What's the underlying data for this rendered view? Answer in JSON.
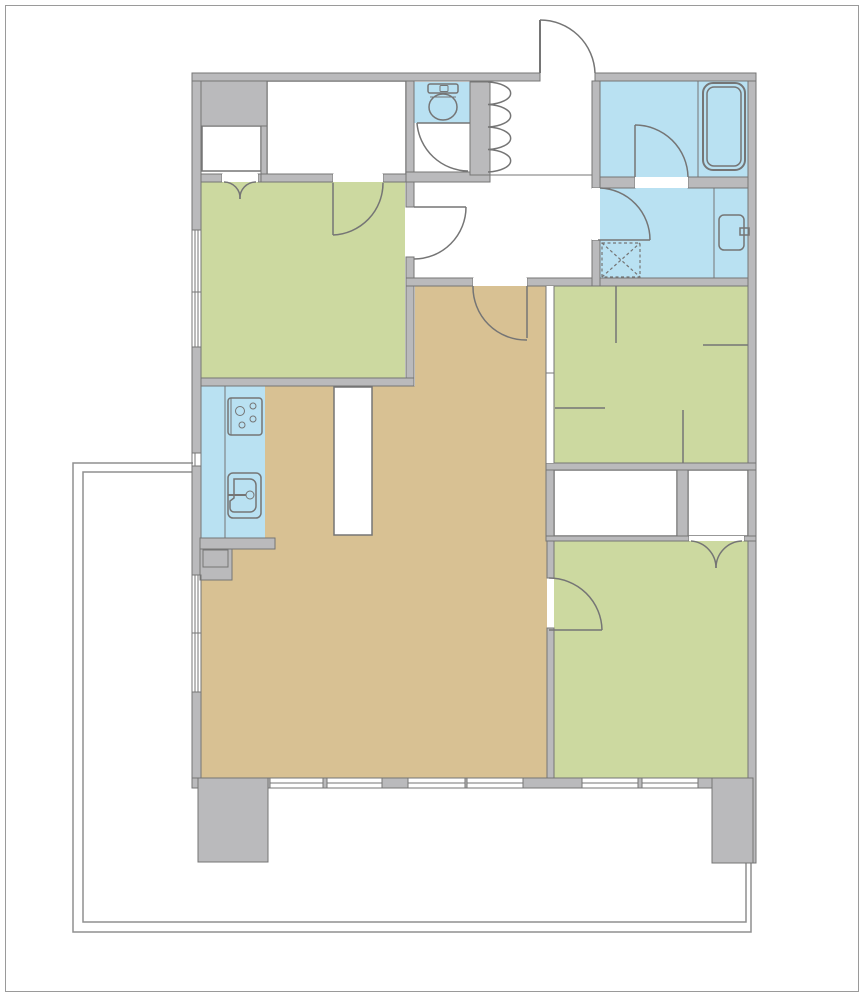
{
  "document": {
    "kind": "apartment-floor-plan",
    "visible_text": []
  },
  "colors": {
    "wall": "#bababc",
    "outline": "#757575",
    "tan": "#d8c193",
    "green": "#ccd9a0",
    "blue": "#b9e1f2",
    "white": "#ffffff",
    "balcony": "#8f8f8f",
    "frame": "#9a9a9a"
  },
  "rooms": [
    {
      "name": "living-dining-kitchen",
      "color_key": "tan"
    },
    {
      "name": "bedroom-west",
      "color_key": "green"
    },
    {
      "name": "bedroom-northeast",
      "color_key": "green"
    },
    {
      "name": "bedroom-southeast",
      "color_key": "green"
    },
    {
      "name": "kitchen-counter-strip",
      "color_key": "blue"
    },
    {
      "name": "bathroom",
      "color_key": "blue"
    },
    {
      "name": "washroom",
      "color_key": "blue"
    },
    {
      "name": "toilet-room",
      "color_key": "blue"
    },
    {
      "name": "entry-genkan",
      "color_key": "white"
    },
    {
      "name": "hallway",
      "color_key": "white"
    },
    {
      "name": "walk-in-closet",
      "color_key": "white"
    },
    {
      "name": "closet-small-west",
      "color_key": "white"
    },
    {
      "name": "closet-row-large",
      "color_key": "white"
    },
    {
      "name": "closet-row-small",
      "color_key": "white"
    },
    {
      "name": "balcony",
      "color_key": "white"
    }
  ],
  "fixtures": [
    "bathtub-icon",
    "toilet-icon",
    "washbasin-icon",
    "washing-machine-icon",
    "stove-icon",
    "kitchen-sink-icon",
    "island-counter",
    "shoe-cabinet-icon"
  ],
  "doors": [
    "entrance-door",
    "bathroom-door",
    "washroom-door",
    "toilet-door",
    "bedroom-west-hall-door",
    "walk-in-closet-door",
    "closet-double-door-west",
    "living-hall-door",
    "bedroom-southeast-door",
    "closet-double-door-southeast",
    "sliding-partition-northeast"
  ]
}
